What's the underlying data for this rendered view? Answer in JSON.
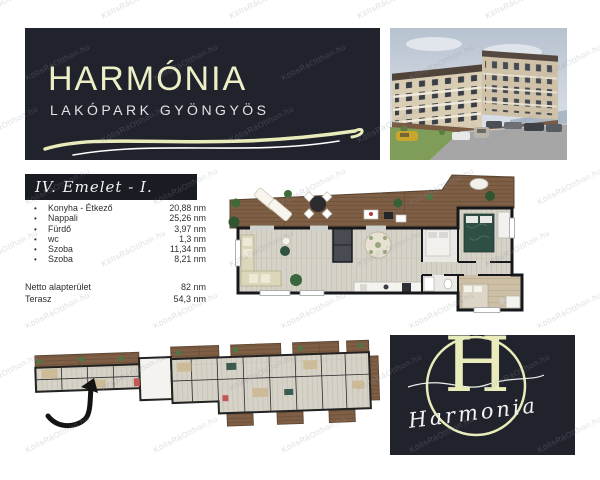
{
  "watermark": {
    "text": "KöltsRáOtthon.hu"
  },
  "brand": {
    "name": "HARMÓNIA",
    "subtitle": "LAKÓPARK GYÖNGYÖS",
    "logo_monogram": "H",
    "logo_script": "Harmonia",
    "colors": {
      "panel_bg": "#20222c",
      "accent_cream": "#edf0c6",
      "text_white": "#f2f2f2"
    }
  },
  "unit": {
    "floor_label": "IV. Emelet -  I.",
    "bullet": "•",
    "rooms": [
      {
        "name": "Konyha - Étkező",
        "area": "20,88 nm"
      },
      {
        "name": "Nappali",
        "area": "25,26 nm"
      },
      {
        "name": "Fürdő",
        "area": "3,97 nm"
      },
      {
        "name": "wc",
        "area": "1,3 nm"
      },
      {
        "name": "Szoba",
        "area": "11,34 nm"
      },
      {
        "name": "Szoba",
        "area": "8,21 nm"
      }
    ],
    "summary": [
      {
        "name": "Netto alapterület",
        "area": "82 nm"
      },
      {
        "name": "Terasz",
        "area": "54,3 nm"
      }
    ]
  },
  "images": {
    "building_photo": "apartment-building-3d-rendering",
    "unit_floorplan": "apartment-top-view-floor-plan",
    "level_floorplan": "building-level-floor-plan-with-arrow"
  }
}
